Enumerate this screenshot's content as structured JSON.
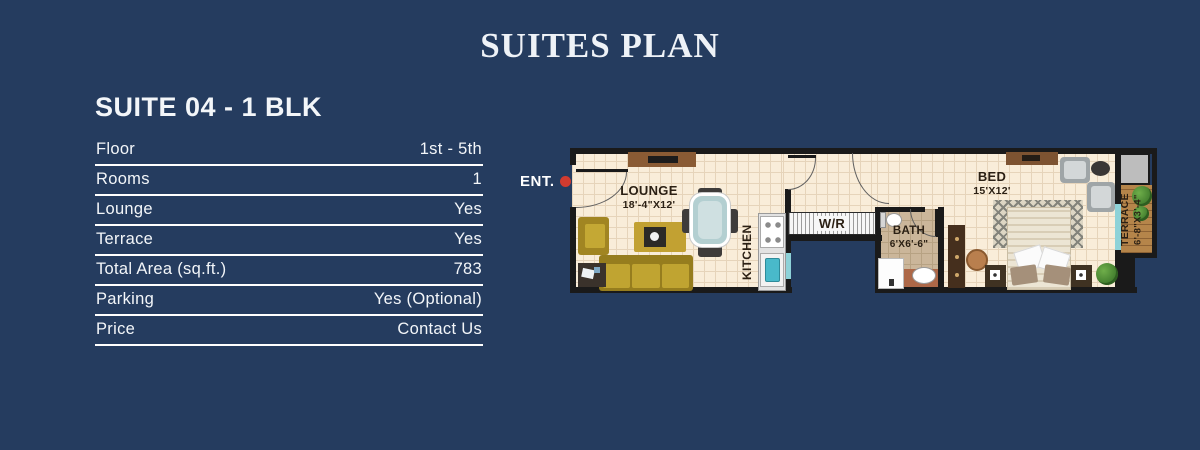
{
  "page": {
    "title": "SUITES PLAN",
    "background_color": "#253c5f",
    "text_color": "#f3f6f9"
  },
  "suite_panel": {
    "heading": "SUITE 04 - 1 BLK",
    "rows": [
      {
        "label": "Floor",
        "value": "1st - 5th"
      },
      {
        "label": "Rooms",
        "value": "1"
      },
      {
        "label": "Lounge",
        "value": "Yes"
      },
      {
        "label": "Terrace",
        "value": "Yes"
      },
      {
        "label": "Total Area (sq.ft.)",
        "value": "783"
      },
      {
        "label": "Parking",
        "value": "Yes (Optional)"
      },
      {
        "label": "Price",
        "value": "Contact Us"
      }
    ]
  },
  "floor_plan": {
    "entrance_label": "ENT.",
    "entrance_marker_color": "#d23b2f",
    "rooms": {
      "lounge": {
        "name": "LOUNGE",
        "size": "18'-4\"X12'"
      },
      "kitchen": {
        "name": "KITCHEN"
      },
      "wardrobe": {
        "name": "W/R"
      },
      "bath": {
        "name": "BATH",
        "size": "6'X6'-6\""
      },
      "bed": {
        "name": "BED",
        "size": "15'X12'"
      },
      "terrace": {
        "name": "TERRACE",
        "size": "6'-8\"X3'-4\""
      }
    },
    "colors": {
      "wall": "#1a1a1a",
      "floor": "#f9edd9",
      "floor_grid": "#e6d4ba",
      "bath_floor": "#cbb69a",
      "terrace_wood": "#b5854a",
      "label_text": "#2b2014",
      "window_glass": "#8ed2d8"
    }
  }
}
